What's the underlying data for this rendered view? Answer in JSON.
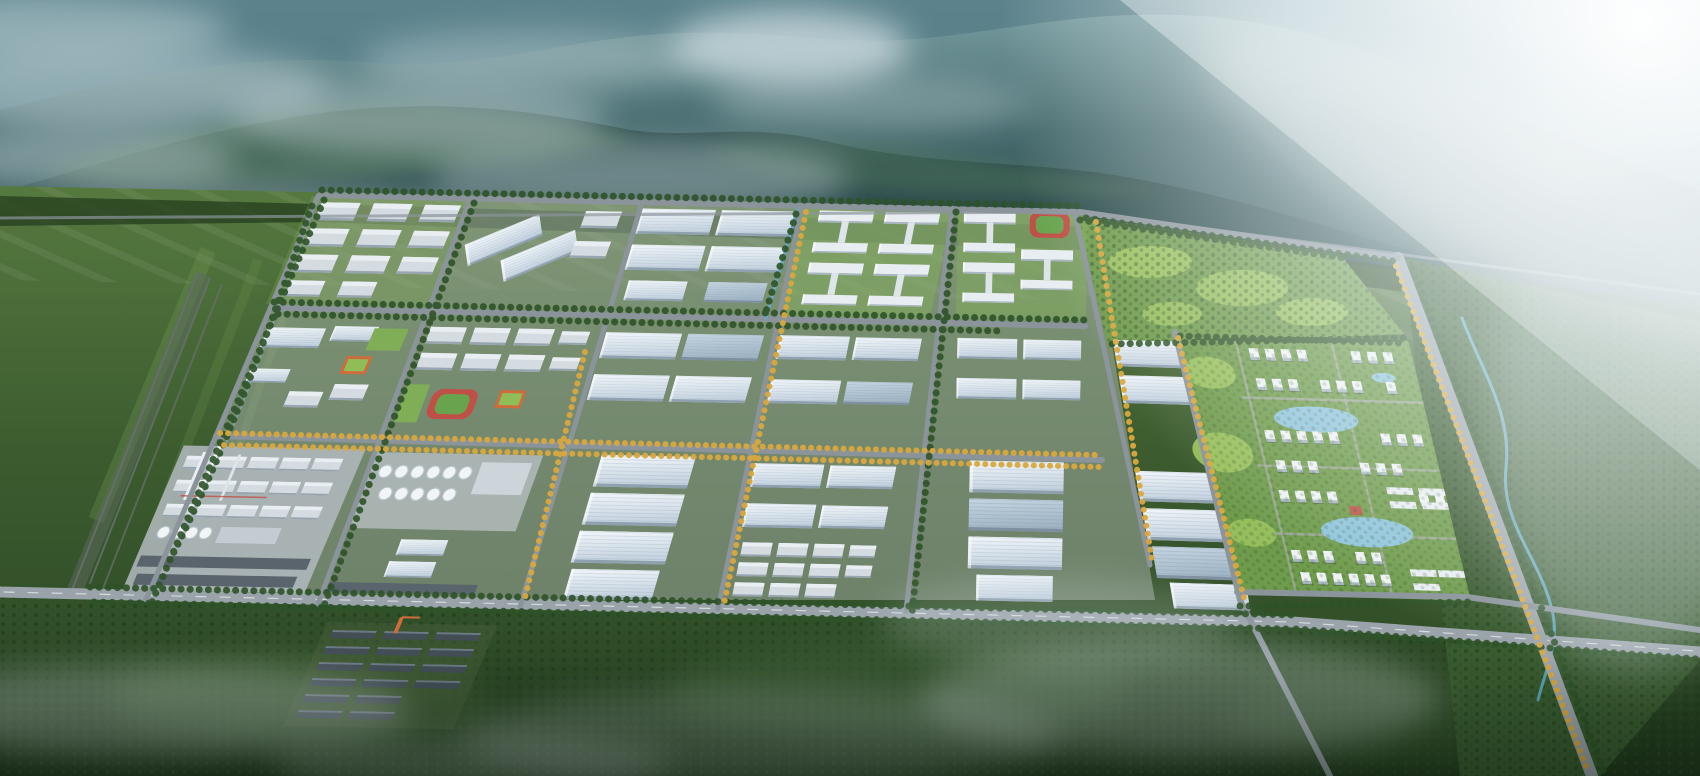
{
  "scene": {
    "type": "aerial-architectural-rendering",
    "subject": "large industrial park with warehouse blocks, chemical plant, dormitory campus, golf-style green park and residential community at the foot of forested mountains",
    "elements": [
      "misty-mountain-range",
      "fog-clouds",
      "sun-glare-beam",
      "farmland-band",
      "industrial-park-grid",
      "warehouse-buildings",
      "sawtooth-factories",
      "chemical-plant",
      "storage-tanks",
      "smoke-stacks",
      "dormitory-campus",
      "running-track-fields",
      "orange-accent-buildings",
      "tree-lined-roads",
      "yellow-foliage-avenues",
      "canal",
      "greenhouse-rows",
      "golf-park-hills",
      "residential-community",
      "ponds",
      "boulevard",
      "winding-stream",
      "railway-lines",
      "foreground-forest",
      "ground-mist"
    ]
  },
  "palette": {
    "haze_top": "#8fb0b4",
    "mountain_far": "#59808a",
    "mountain_mid": "#3f666b",
    "mountain_near": "#2e4e4e",
    "mountain_lit": "#567d5e",
    "fog": "#ccdbe0",
    "glare": "#ffffff",
    "field": "#56793f",
    "field_light": "#79a058",
    "forest": "#3a5c30",
    "forest_dark": "#27411f",
    "hill_bright": "#9cc45f",
    "lawn": "#6f9b4c",
    "road": "#8b949b",
    "road_main": "#9aa3aa",
    "road_dash": "#eef2f4",
    "tree": "#2e5228",
    "tree_yellow": "#d9a83f",
    "roof_light": "#eef4f9",
    "roof_mid": "#c7d4e0",
    "roof_dark": "#9dadbc",
    "glass_roof": "#b4c5d3",
    "wall": "#e3e9ee",
    "wall_shadow": "#a9b7c3",
    "shed": "#d4dbe1",
    "shed_dark": "#4a555e",
    "accent_orange": "#d06c3c",
    "accent_red": "#c05047",
    "sport_green": "#68a44e",
    "pond": "#8ec4da",
    "canal": "#62aecd",
    "tank": "#f1f5f7",
    "rail": "#66716c",
    "mist": "#dfe9ec"
  }
}
